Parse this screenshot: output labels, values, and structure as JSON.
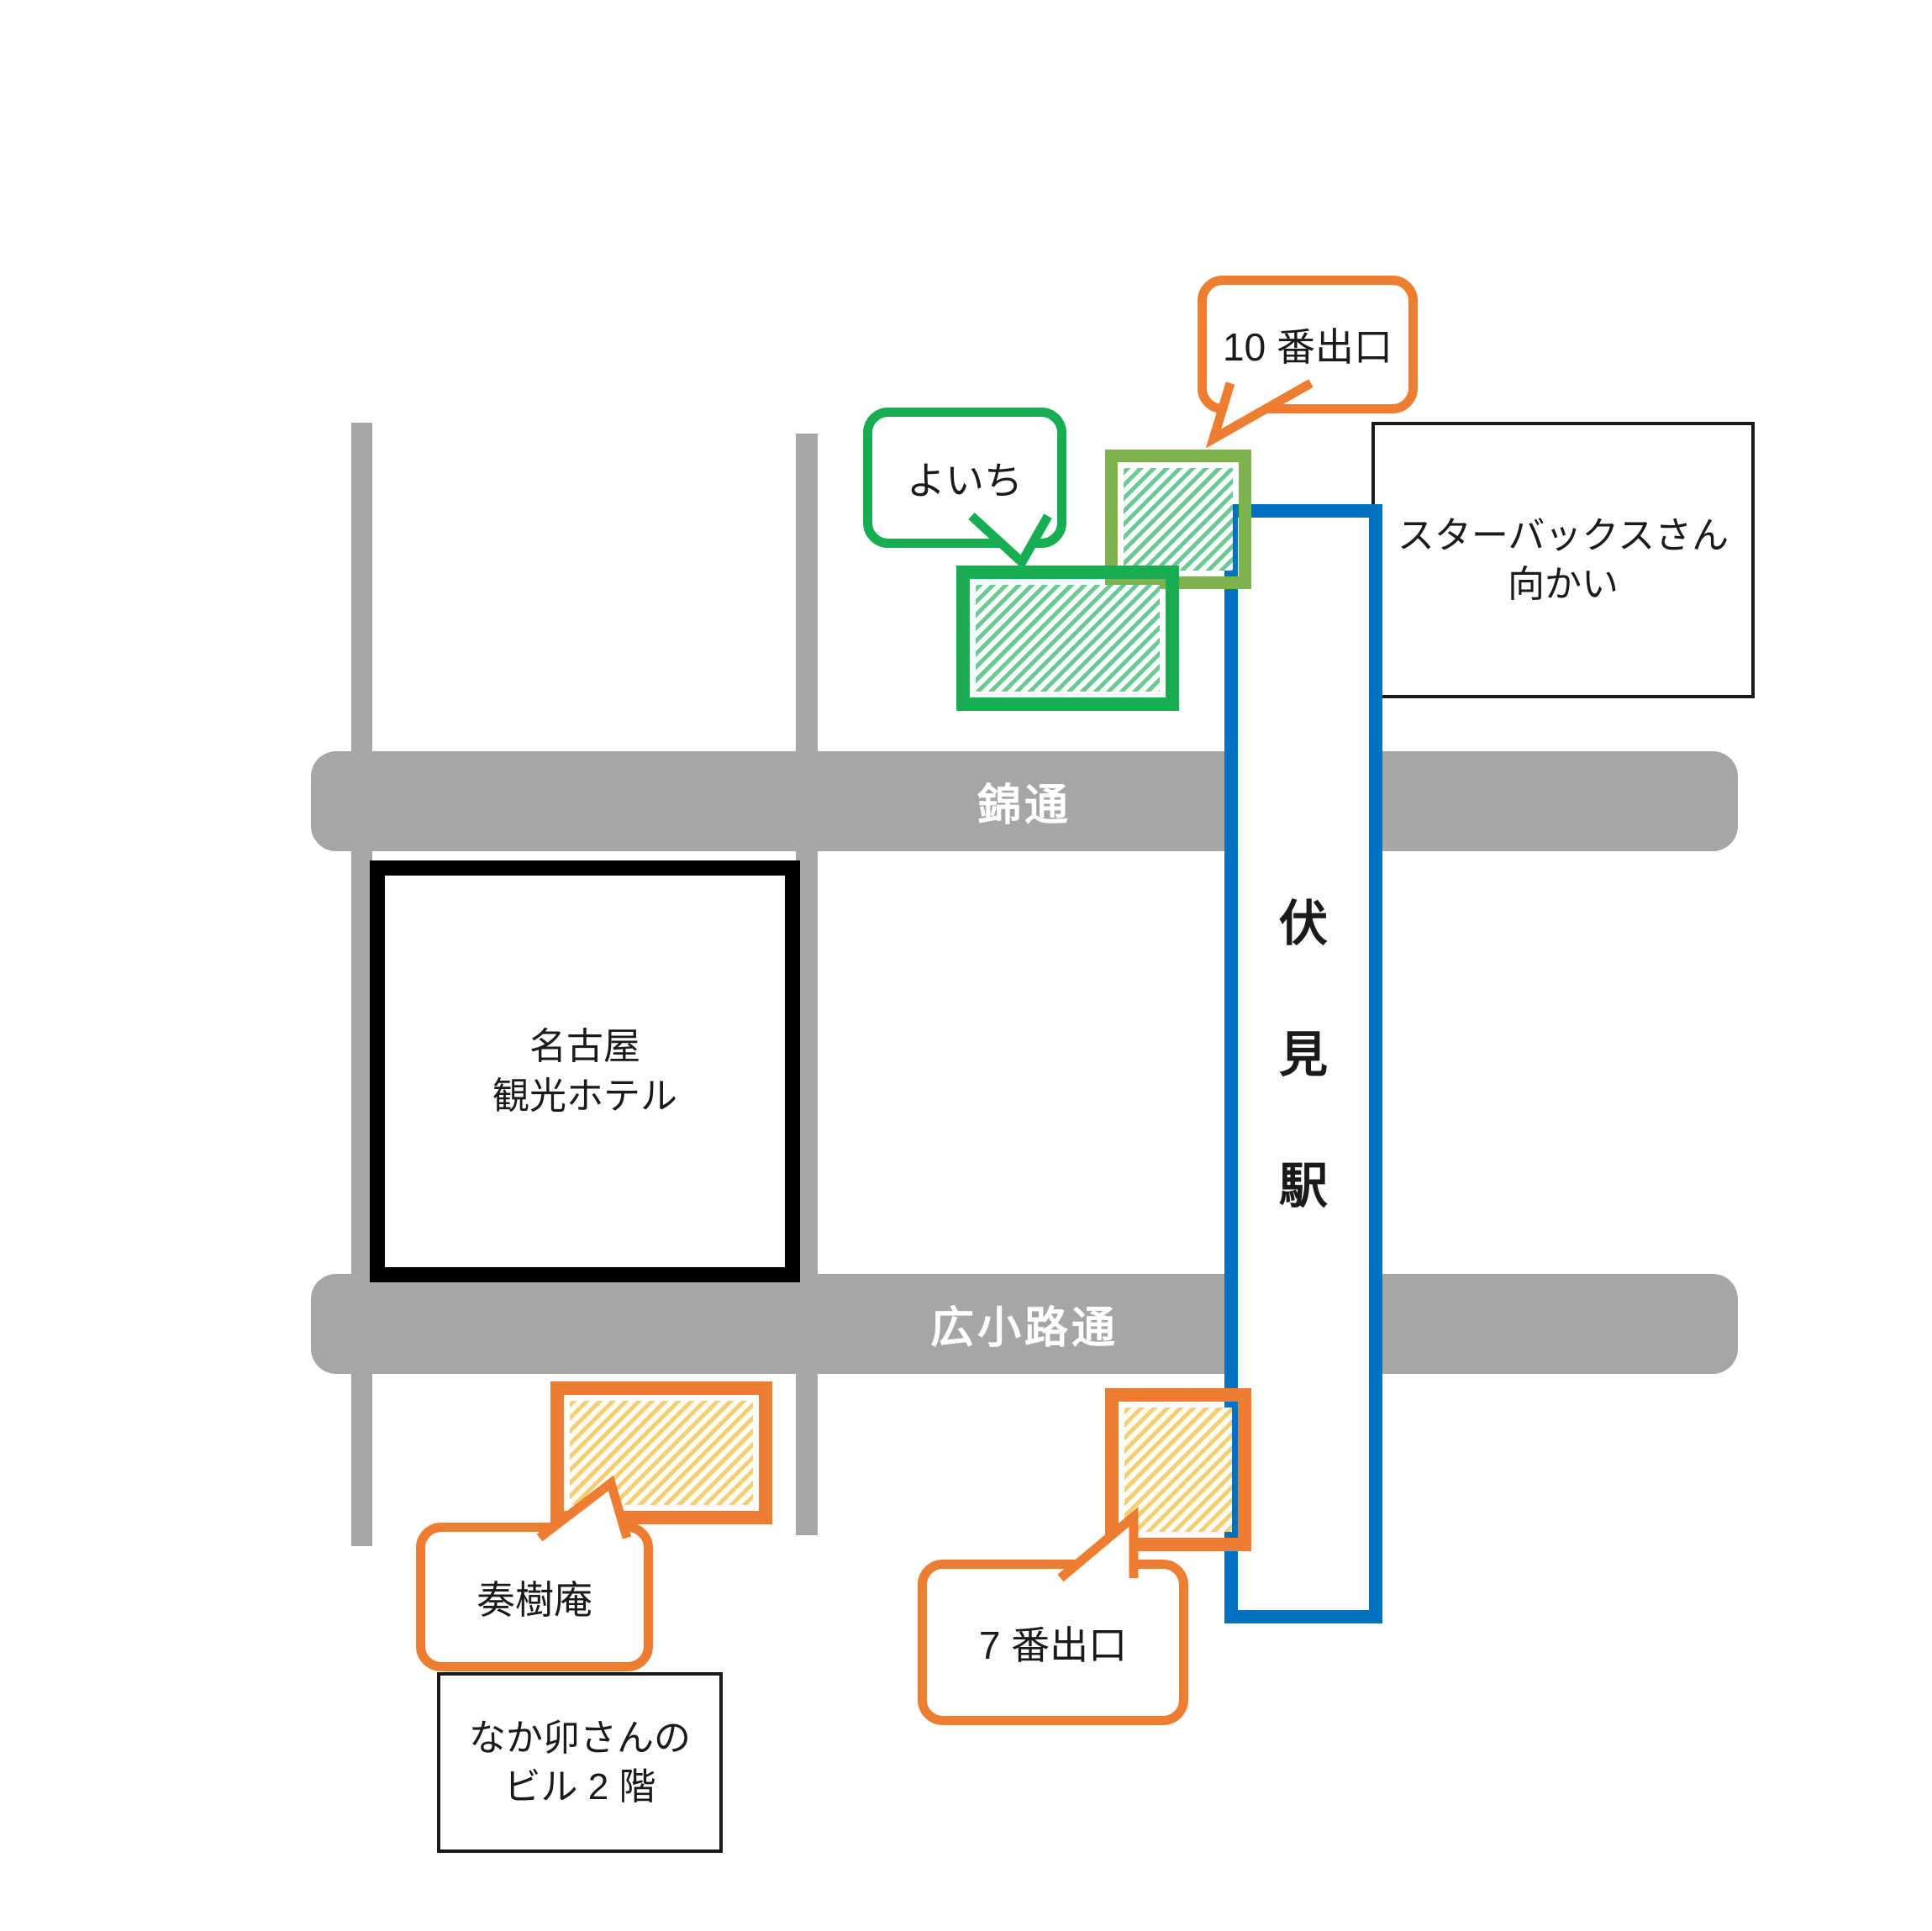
{
  "colors": {
    "road": "#A6A6A6",
    "blue": "#0070C0",
    "green": "#17AD52",
    "olive": "#7DB24E",
    "orange": "#ED7D31",
    "ink": "#1A1A1A",
    "hatch-green": "#6CC993",
    "hatch-yellow": "#F2CE75"
  },
  "roads": {
    "nishiki": {
      "label": "錦通"
    },
    "hirokoji": {
      "label": "広小路通"
    }
  },
  "station": {
    "name": "伏見駅",
    "chars": [
      "伏",
      "見",
      "駅"
    ]
  },
  "buildings": {
    "hotel": {
      "lines": [
        "名古屋",
        "観光ホテル"
      ]
    },
    "starbucks_note": {
      "lines": [
        "スターバックスさん",
        "向かい"
      ]
    },
    "nakau_note": {
      "lines": [
        "なか卯さんの",
        "ビル 2 階"
      ]
    }
  },
  "callouts": {
    "exit10": {
      "label": "10 番出口"
    },
    "yoichi": {
      "label": "よいち"
    },
    "soujuan": {
      "label": "奏樹庵"
    },
    "exit7": {
      "label": "7 番出口"
    }
  }
}
